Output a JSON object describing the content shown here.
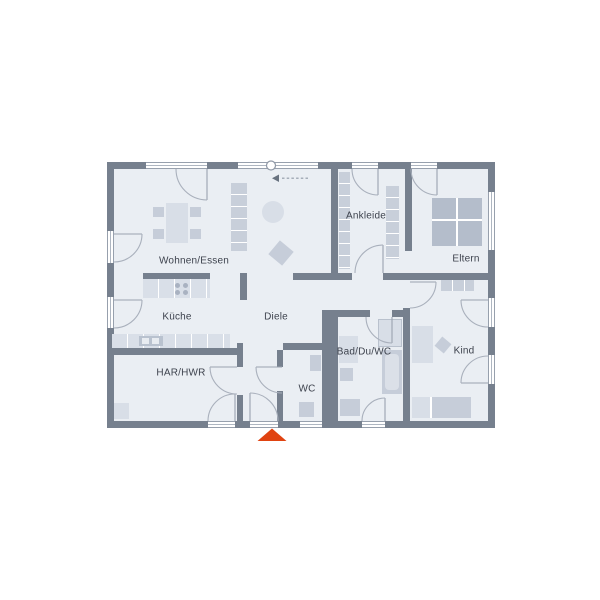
{
  "plan_title": "",
  "rooms": [
    {
      "id": "wohnen-essen",
      "label": "Wohnen/Essen"
    },
    {
      "id": "kueche",
      "label": "Küche"
    },
    {
      "id": "har-hwr",
      "label": "HAR/HWR"
    },
    {
      "id": "diele",
      "label": "Diele"
    },
    {
      "id": "wc",
      "label": "WC"
    },
    {
      "id": "bad-du-wc",
      "label": "Bad/Du/WC"
    },
    {
      "id": "ankleide",
      "label": "Ankleide"
    },
    {
      "id": "eltern",
      "label": "Eltern"
    },
    {
      "id": "kind",
      "label": "Kind"
    }
  ],
  "colors": {
    "background": "#ffffff",
    "wall": "#76808e",
    "floor": "#eaeef3",
    "furniture": "#c6cdd9",
    "furniture_light": "#d8dee7",
    "bed": "#b4bdcb",
    "line": "#a9b0bc",
    "text": "#3d424d",
    "accent": "#e04311"
  },
  "markers": {
    "entrance": "entrance-triangle",
    "window_axis": "circle-on-window",
    "slide_direction": "left-arrow-with-dashes"
  }
}
